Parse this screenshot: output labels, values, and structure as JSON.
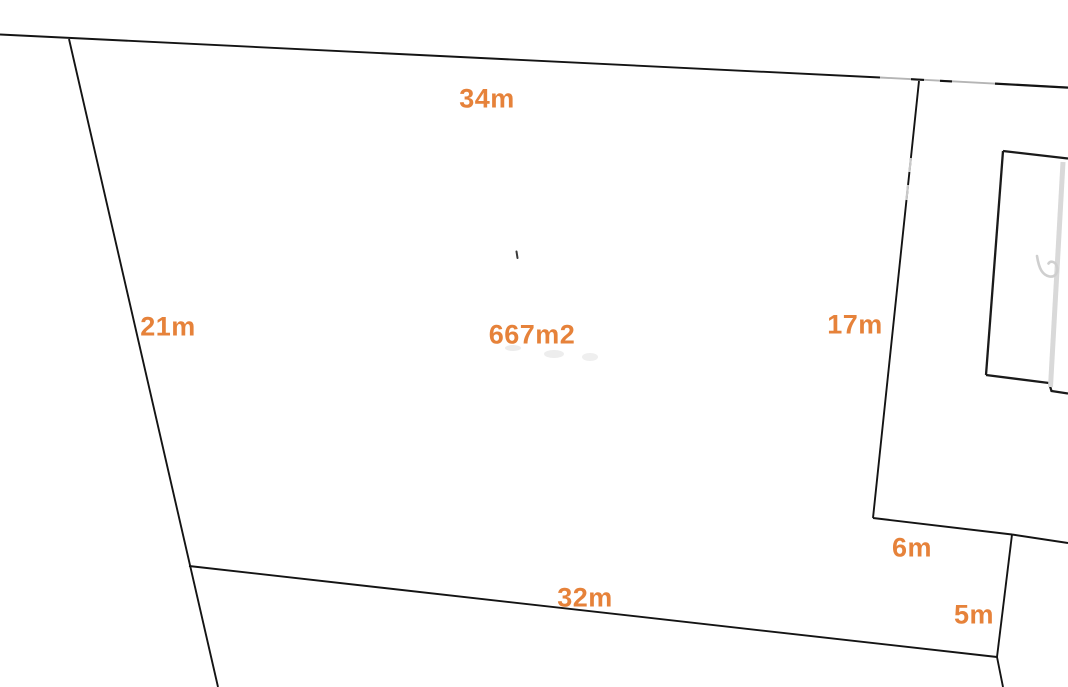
{
  "diagram": {
    "kind": "land-plot-sketch",
    "area_label": "667m2",
    "dimensions": [
      {
        "id": "top-edge",
        "text": "34m"
      },
      {
        "id": "left-edge",
        "text": "21m"
      },
      {
        "id": "right-edge",
        "text": "17m"
      },
      {
        "id": "bottom-edge",
        "text": "32m"
      },
      {
        "id": "notch-upper-edge",
        "text": "6m"
      },
      {
        "id": "notch-lower-edge",
        "text": "5m"
      }
    ],
    "colors": {
      "label_orange": "#e6823a",
      "boundary_black": "#141414",
      "secondary_gray": "#d9d9d9",
      "background": "#ffffff"
    }
  }
}
